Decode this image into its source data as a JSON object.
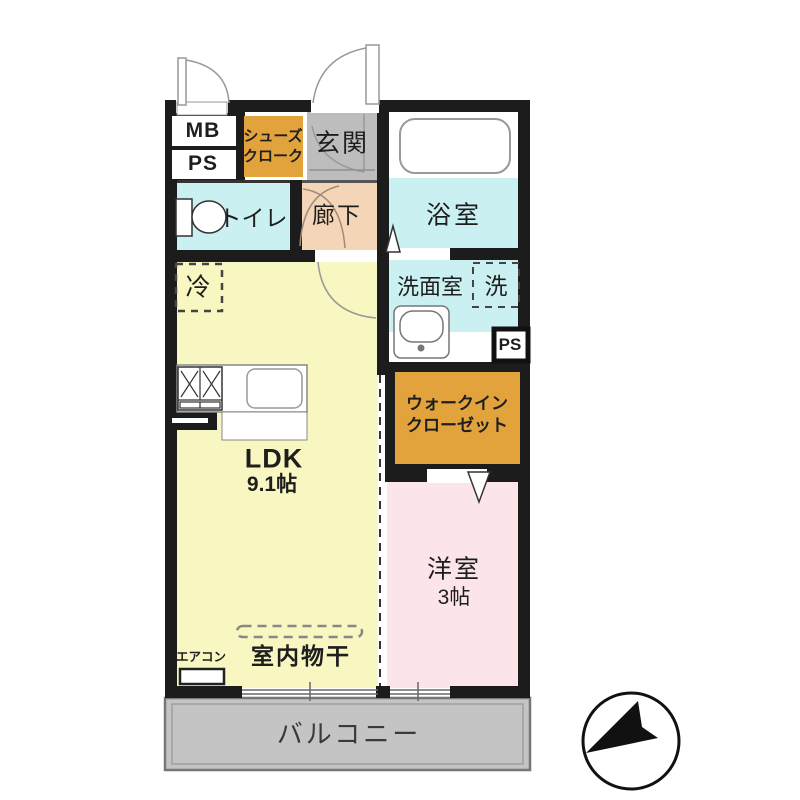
{
  "rooms": {
    "mb": "MB",
    "ps_top": "PS",
    "shoe_closet": [
      "シューズ",
      "クローク"
    ],
    "entrance": "玄関",
    "bathroom": "浴室",
    "toilet": "トイレ",
    "hallway": "廊下",
    "washroom": "洗面室",
    "washer": "洗",
    "ps_small": "PS",
    "walkin_closet": [
      "ウォークイン",
      "クローゼット"
    ],
    "refrigerator": "冷",
    "ldk": {
      "name": "LDK",
      "size": "9.1帖"
    },
    "bedroom": {
      "name": "洋室",
      "size": "3帖"
    },
    "indoor_drying": "室内物干",
    "aircon": "エアコン",
    "balcony": "バルコニー"
  },
  "colors": {
    "wall": "#1c1c1c",
    "ldk_yellow": "#F8F6C1",
    "wet_area_cyan": "#CBF0F2",
    "hallway_peach": "#F4D5B7",
    "bedroom_pink": "#FBE5E8",
    "closet_orange": "#E2A33C",
    "entrance_gray": "#BDBDBD",
    "balcony_gray": "#C4C4C4"
  }
}
